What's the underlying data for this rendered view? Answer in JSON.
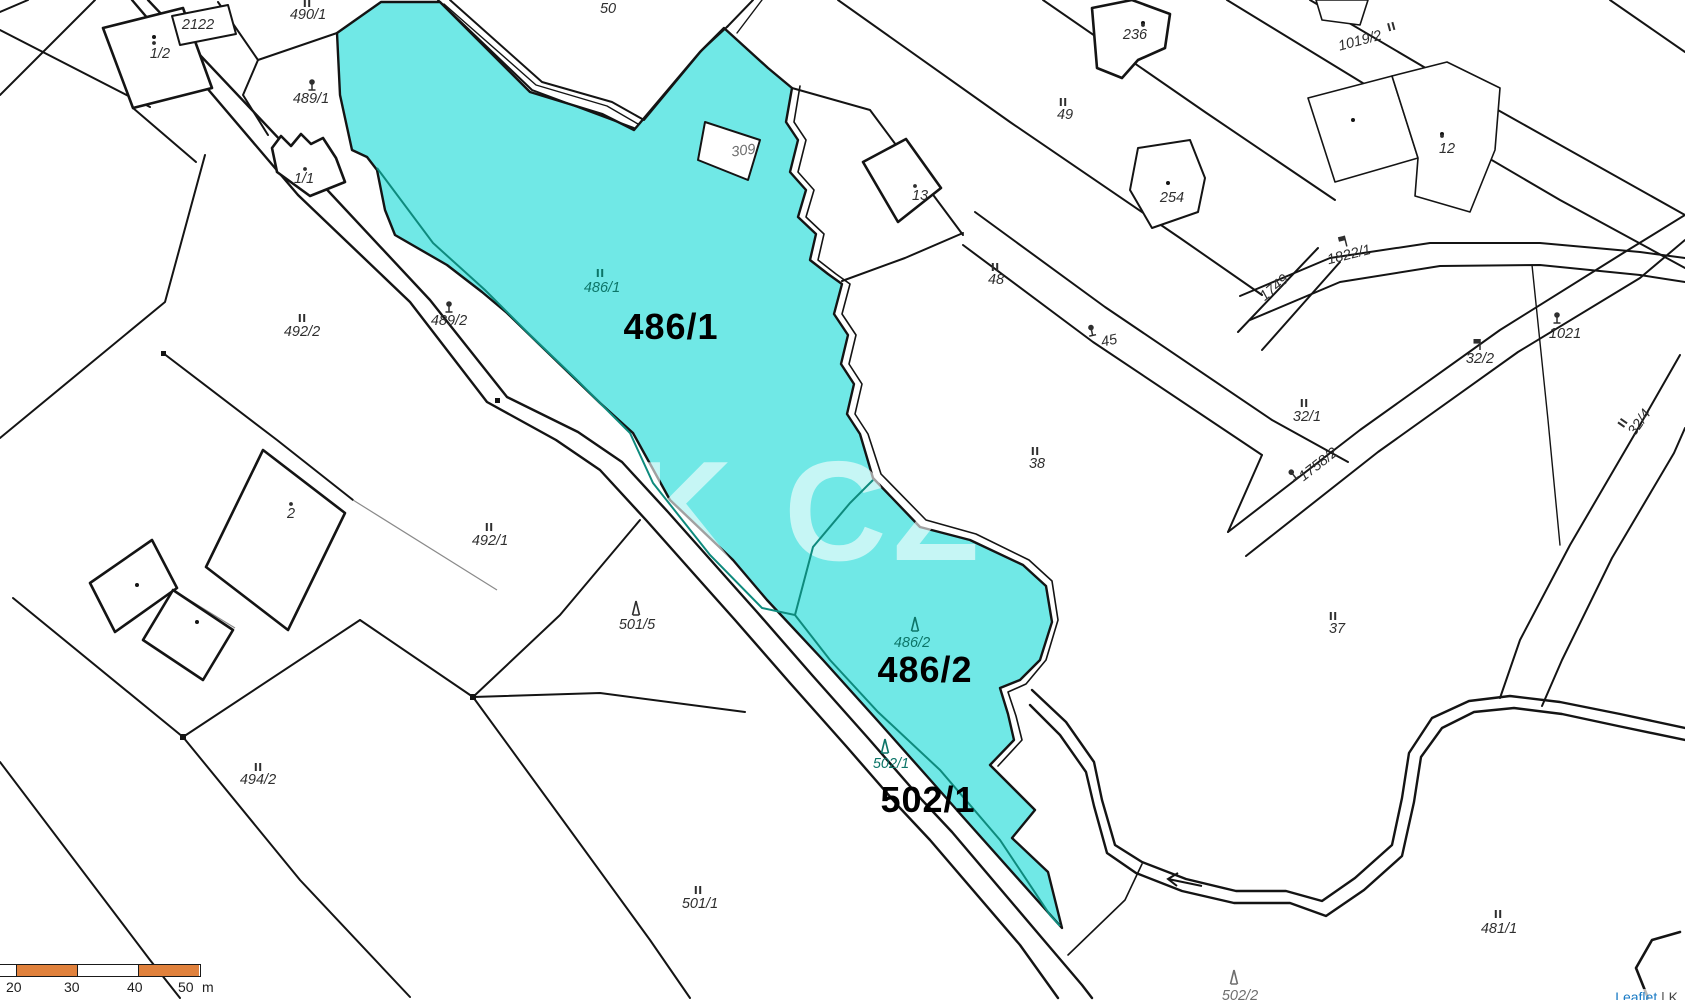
{
  "map": {
    "watermark": "K CZ",
    "colors": {
      "highlight_fill": "#70E8E6",
      "inner_boundary": "#0E8A7D",
      "teal_label": "#0C7568",
      "dark_label": "#2E2E2E",
      "faint_label": "#6E6E6E",
      "line": "#141414",
      "scalebar_orange": "#E0813C",
      "attribution_link_blue": "#1779C4"
    },
    "highlight_labels": [
      {
        "text": "486/1",
        "x": 671,
        "y": 339
      },
      {
        "text": "486/2",
        "x": 925,
        "y": 682
      },
      {
        "text": "502/1",
        "x": 928,
        "y": 812
      }
    ],
    "parcel_labels": [
      {
        "text": "2122",
        "x": 198,
        "y": 29,
        "rot": 0,
        "color": "dark",
        "sym": null,
        "sdx": 0,
        "sdy": 0
      },
      {
        "text": "1/2",
        "x": 160,
        "y": 58,
        "rot": 0,
        "color": "dark",
        "sym": "dot",
        "sdx": -6,
        "sdy": -15
      },
      {
        "text": "490/1",
        "x": 308,
        "y": 19,
        "rot": 0,
        "color": "dark",
        "sym": "meadow",
        "sdx": -1,
        "sdy": -14
      },
      {
        "text": "50",
        "x": 608,
        "y": 13,
        "rot": 0,
        "color": "dark",
        "sym": null,
        "sdx": 0,
        "sdy": 0
      },
      {
        "text": "489/1",
        "x": 311,
        "y": 103,
        "rot": 0,
        "color": "dark",
        "sym": "tree",
        "sdx": 1,
        "sdy": -16
      },
      {
        "text": "1/1",
        "x": 304,
        "y": 183,
        "rot": 0,
        "color": "dark",
        "sym": "dot",
        "sdx": 1,
        "sdy": -14
      },
      {
        "text": "489/2",
        "x": 449,
        "y": 325,
        "rot": 0,
        "color": "dark",
        "sym": "tree",
        "sdx": 0,
        "sdy": -16
      },
      {
        "text": "309",
        "x": 744,
        "y": 155,
        "rot": -8,
        "color": "faint",
        "sym": null,
        "sdx": 0,
        "sdy": 0
      },
      {
        "text": "13",
        "x": 920,
        "y": 200,
        "rot": 0,
        "color": "dark",
        "sym": "dot",
        "sdx": -5,
        "sdy": -14
      },
      {
        "text": "236",
        "x": 1135,
        "y": 39,
        "rot": 0,
        "color": "dark",
        "sym": "dot",
        "sdx": 8,
        "sdy": -14
      },
      {
        "text": "49",
        "x": 1065,
        "y": 119,
        "rot": 0,
        "color": "dark",
        "sym": "meadow",
        "sdx": -2,
        "sdy": -15
      },
      {
        "text": "1019/2",
        "x": 1361,
        "y": 45,
        "rot": -15,
        "color": "dark",
        "sym": "meadow",
        "sdx": 34,
        "sdy": -8
      },
      {
        "text": "12",
        "x": 1447,
        "y": 153,
        "rot": 0,
        "color": "dark",
        "sym": "dot",
        "sdx": -5,
        "sdy": -17
      },
      {
        "text": "254",
        "x": 1172,
        "y": 202,
        "rot": 0,
        "color": "dark",
        "sym": null,
        "sdx": 0,
        "sdy": 0
      },
      {
        "text": "48",
        "x": 996,
        "y": 284,
        "rot": 0,
        "color": "dark",
        "sym": "meadow",
        "sdx": -1,
        "sdy": -15
      },
      {
        "text": "1822/1",
        "x": 1350,
        "y": 259,
        "rot": -14,
        "color": "dark",
        "sym": "flag",
        "sdx": -2,
        "sdy": -15
      },
      {
        "text": "1749",
        "x": 1277,
        "y": 291,
        "rot": -40,
        "color": "dark",
        "sym": null,
        "sdx": 0,
        "sdy": 0
      },
      {
        "text": "45",
        "x": 1110,
        "y": 345,
        "rot": -12,
        "color": "dark",
        "sym": "tree",
        "sdx": -15,
        "sdy": -16
      },
      {
        "text": "1021",
        "x": 1565,
        "y": 338,
        "rot": 0,
        "color": "dark",
        "sym": "tree",
        "sdx": -8,
        "sdy": -18
      },
      {
        "text": "32/2",
        "x": 1480,
        "y": 363,
        "rot": 0,
        "color": "dark",
        "sym": "flag",
        "sdx": -2,
        "sdy": -15
      },
      {
        "text": "32/1",
        "x": 1307,
        "y": 421,
        "rot": 0,
        "color": "dark",
        "sym": "meadow",
        "sdx": -3,
        "sdy": -16
      },
      {
        "text": "32/4",
        "x": 1643,
        "y": 425,
        "rot": -55,
        "color": "dark",
        "sym": "meadow",
        "sdx": -10,
        "sdy": -16
      },
      {
        "text": "1758/2",
        "x": 1321,
        "y": 468,
        "rot": -38,
        "color": "dark",
        "sym": "tree",
        "sdx": -26,
        "sdy": -10
      },
      {
        "text": "492/2",
        "x": 302,
        "y": 336,
        "rot": 0,
        "color": "dark",
        "sym": "meadow",
        "sdx": 0,
        "sdy": -16
      },
      {
        "text": "2",
        "x": 291,
        "y": 518,
        "rot": 0,
        "color": "dark",
        "sym": "dot",
        "sdx": 0,
        "sdy": -14
      },
      {
        "text": "492/1",
        "x": 490,
        "y": 545,
        "rot": 0,
        "color": "dark",
        "sym": "meadow",
        "sdx": -1,
        "sdy": -16
      },
      {
        "text": "38",
        "x": 1037,
        "y": 468,
        "rot": 0,
        "color": "dark",
        "sym": "meadow",
        "sdx": -2,
        "sdy": -15
      },
      {
        "text": "501/5",
        "x": 637,
        "y": 629,
        "rot": 0,
        "color": "dark",
        "sym": "conifer",
        "sdx": -1,
        "sdy": -16
      },
      {
        "text": "37",
        "x": 1337,
        "y": 633,
        "rot": 0,
        "color": "dark",
        "sym": "meadow",
        "sdx": -4,
        "sdy": -15
      },
      {
        "text": "494/2",
        "x": 258,
        "y": 784,
        "rot": 0,
        "color": "dark",
        "sym": "meadow",
        "sdx": 0,
        "sdy": -15
      },
      {
        "text": "501/1",
        "x": 700,
        "y": 908,
        "rot": 0,
        "color": "dark",
        "sym": "meadow",
        "sdx": -2,
        "sdy": -16
      },
      {
        "text": "481/1",
        "x": 1499,
        "y": 933,
        "rot": 0,
        "color": "dark",
        "sym": "meadow",
        "sdx": -1,
        "sdy": -17
      },
      {
        "text": "502/2",
        "x": 1240,
        "y": 1000,
        "rot": 0,
        "color": "faint",
        "sym": "conifer",
        "sdx": -6,
        "sdy": -18
      },
      {
        "text": "486/1",
        "x": 602,
        "y": 292,
        "rot": 0,
        "color": "teal",
        "sym": "meadow",
        "sdx": -2,
        "sdy": -17
      },
      {
        "text": "486/2",
        "x": 912,
        "y": 647,
        "rot": 0,
        "color": "teal",
        "sym": "conifer",
        "sdx": 3,
        "sdy": -18
      },
      {
        "text": "502/1",
        "x": 891,
        "y": 768,
        "rot": 0,
        "color": "teal",
        "sym": "conifer",
        "sdx": -6,
        "sdy": -17
      }
    ],
    "scalebar": {
      "ticks": [
        "20",
        "30",
        "40",
        "50"
      ],
      "unit": "m"
    },
    "attribution": {
      "link_text": "Leaflet",
      "separator": " | K"
    }
  }
}
